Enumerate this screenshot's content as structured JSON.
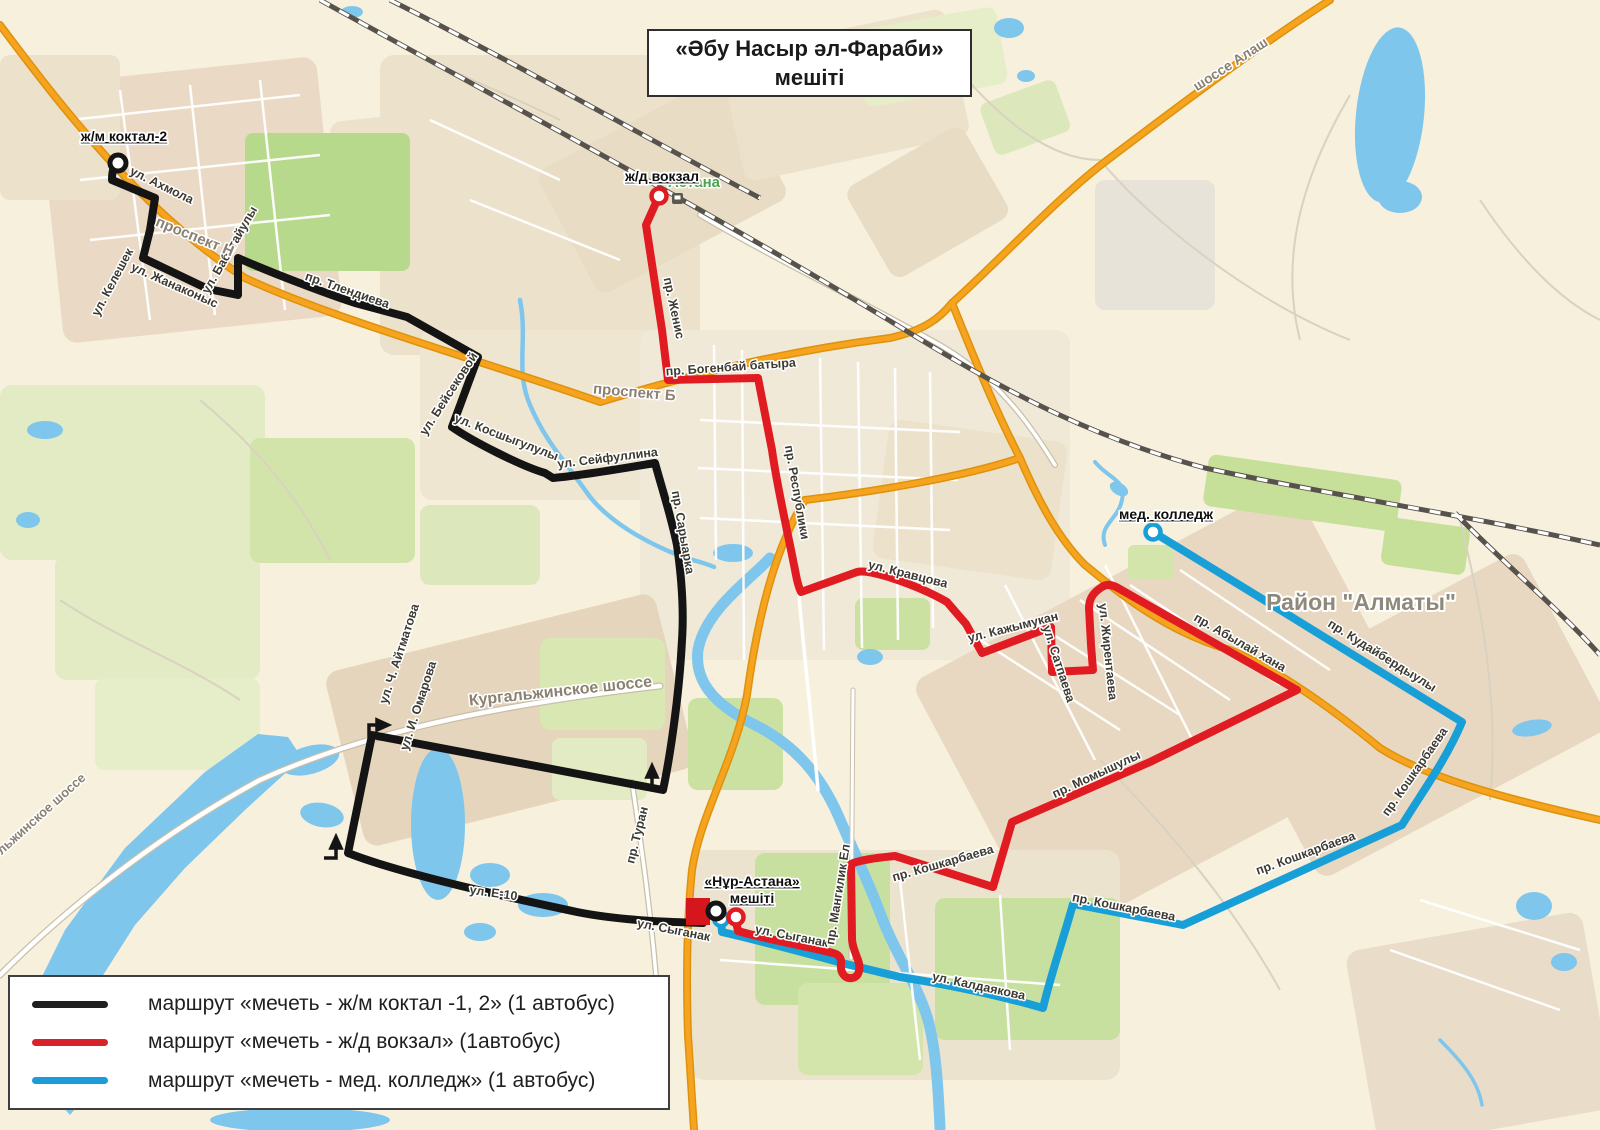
{
  "title": {
    "line1": "«Әбу Насыр әл-Фараби»",
    "line2": "мешіті"
  },
  "legend": {
    "items": [
      {
        "color": "#1f1f1f",
        "label": "маршрут «мечеть - ж/м коктал -1, 2» (1 автобус)"
      },
      {
        "color": "#d8232a",
        "label": "маршрут «мечеть - ж/д вокзал» (1автобус)"
      },
      {
        "color": "#1b9cd8",
        "label": "маршрут «мечеть - мед. колледж» (1 автобус)"
      }
    ]
  },
  "colors": {
    "route_black": "#141414",
    "route_red": "#e11b22",
    "route_blue": "#189fd7",
    "highway_orange": "#f6a41f",
    "water": "#7fc6ed",
    "mosque_marker": "#d6161d"
  },
  "map": {
    "labels": [
      {
        "t": "Астана",
        "x": 694,
        "y": 187,
        "v": "city"
      },
      {
        "t": "ж/м коктал-2",
        "x": 124,
        "y": 141,
        "v": "poi"
      },
      {
        "t": "ж/д вокзал",
        "x": 662,
        "y": 181,
        "v": "poi"
      },
      {
        "t": "мед. колледж",
        "x": 1166,
        "y": 519,
        "v": "poi"
      },
      {
        "t": "«Нұр-Астана»",
        "x": 752,
        "y": 886,
        "v": "poi"
      },
      {
        "t": "мешіті",
        "x": 752,
        "y": 903,
        "v": "poi"
      },
      {
        "t": "Район \"Алматы\"",
        "x": 1361,
        "y": 610,
        "v": "big"
      },
      {
        "t": "ул. Ахмола",
        "x": 160,
        "y": 189,
        "r": 26
      },
      {
        "t": "ул. Келешек",
        "x": 116,
        "y": 284,
        "r": -62
      },
      {
        "t": "ул. Жанаконыс",
        "x": 173,
        "y": 289,
        "r": 24
      },
      {
        "t": "ул. Бабатайулы",
        "x": 233,
        "y": 252,
        "r": -60
      },
      {
        "t": "пр. Тлендиева",
        "x": 346,
        "y": 294,
        "r": 19
      },
      {
        "t": "проспект Н",
        "x": 193,
        "y": 241,
        "r": 22,
        "v": "road"
      },
      {
        "t": "ул. Бейсековой",
        "x": 452,
        "y": 396,
        "r": -57
      },
      {
        "t": "ул. Косшыгулулы",
        "x": 505,
        "y": 441,
        "r": 21
      },
      {
        "t": "ул. Сейфуллина",
        "x": 608,
        "y": 462,
        "r": -7
      },
      {
        "t": "пр. Сарыарка",
        "x": 679,
        "y": 533,
        "r": 80
      },
      {
        "t": "проспект Б",
        "x": 634,
        "y": 397,
        "r": 5,
        "v": "road"
      },
      {
        "t": "пр. Женис",
        "x": 670,
        "y": 309,
        "r": 78
      },
      {
        "t": "пр. Богенбай батыра",
        "x": 731,
        "y": 371,
        "r": -4
      },
      {
        "t": "пр. Республики",
        "x": 793,
        "y": 493,
        "r": 80
      },
      {
        "t": "ул. Кравцова",
        "x": 907,
        "y": 578,
        "r": 14
      },
      {
        "t": "ул. Кажымукан",
        "x": 1014,
        "y": 631,
        "r": -14
      },
      {
        "t": "ул. Сатпаева",
        "x": 1055,
        "y": 665,
        "r": 72
      },
      {
        "t": "ул. Жирентаева",
        "x": 1104,
        "y": 652,
        "r": 84
      },
      {
        "t": "пр. Абылай хана",
        "x": 1238,
        "y": 646,
        "r": 30
      },
      {
        "t": "пр. Кудайбердыулы",
        "x": 1380,
        "y": 659,
        "r": 32
      },
      {
        "t": "пр. Момышулы",
        "x": 1098,
        "y": 778,
        "r": -25
      },
      {
        "t": "пр. Кошкарбаева",
        "x": 944,
        "y": 867,
        "r": -16
      },
      {
        "t": "пр. Кошкарбаева",
        "x": 1123,
        "y": 911,
        "r": 11
      },
      {
        "t": "пр. Кошкарбаева",
        "x": 1418,
        "y": 774,
        "r": -55
      },
      {
        "t": "пр. Кошкарбаева",
        "x": 1307,
        "y": 857,
        "r": -20
      },
      {
        "t": "ул. Калдаякова",
        "x": 978,
        "y": 990,
        "r": 12
      },
      {
        "t": "ул. Сыганак",
        "x": 673,
        "y": 934,
        "r": 11
      },
      {
        "t": "ул. Сыганак",
        "x": 791,
        "y": 940,
        "r": 11
      },
      {
        "t": "пр. Мангилик Ел",
        "x": 842,
        "y": 895,
        "r": -81
      },
      {
        "t": "пр. Туран",
        "x": 641,
        "y": 836,
        "r": -76
      },
      {
        "t": "ул. Е-10",
        "x": 493,
        "y": 897,
        "r": 8
      },
      {
        "t": "ул. Ч. Айтматова",
        "x": 403,
        "y": 655,
        "r": -72
      },
      {
        "t": "ул. И. Омарова",
        "x": 422,
        "y": 707,
        "r": -72
      },
      {
        "t": "Кургальжинское шоссе",
        "x": 561,
        "y": 696,
        "r": -6,
        "v": "road",
        "s": 16
      },
      {
        "t": "льжинское шоссе",
        "x": 44,
        "y": 817,
        "r": -42,
        "v": "road",
        "s": 13
      },
      {
        "t": "шоссе Алаш",
        "x": 1233,
        "y": 68,
        "r": -33,
        "v": "road",
        "s": 14
      }
    ]
  }
}
